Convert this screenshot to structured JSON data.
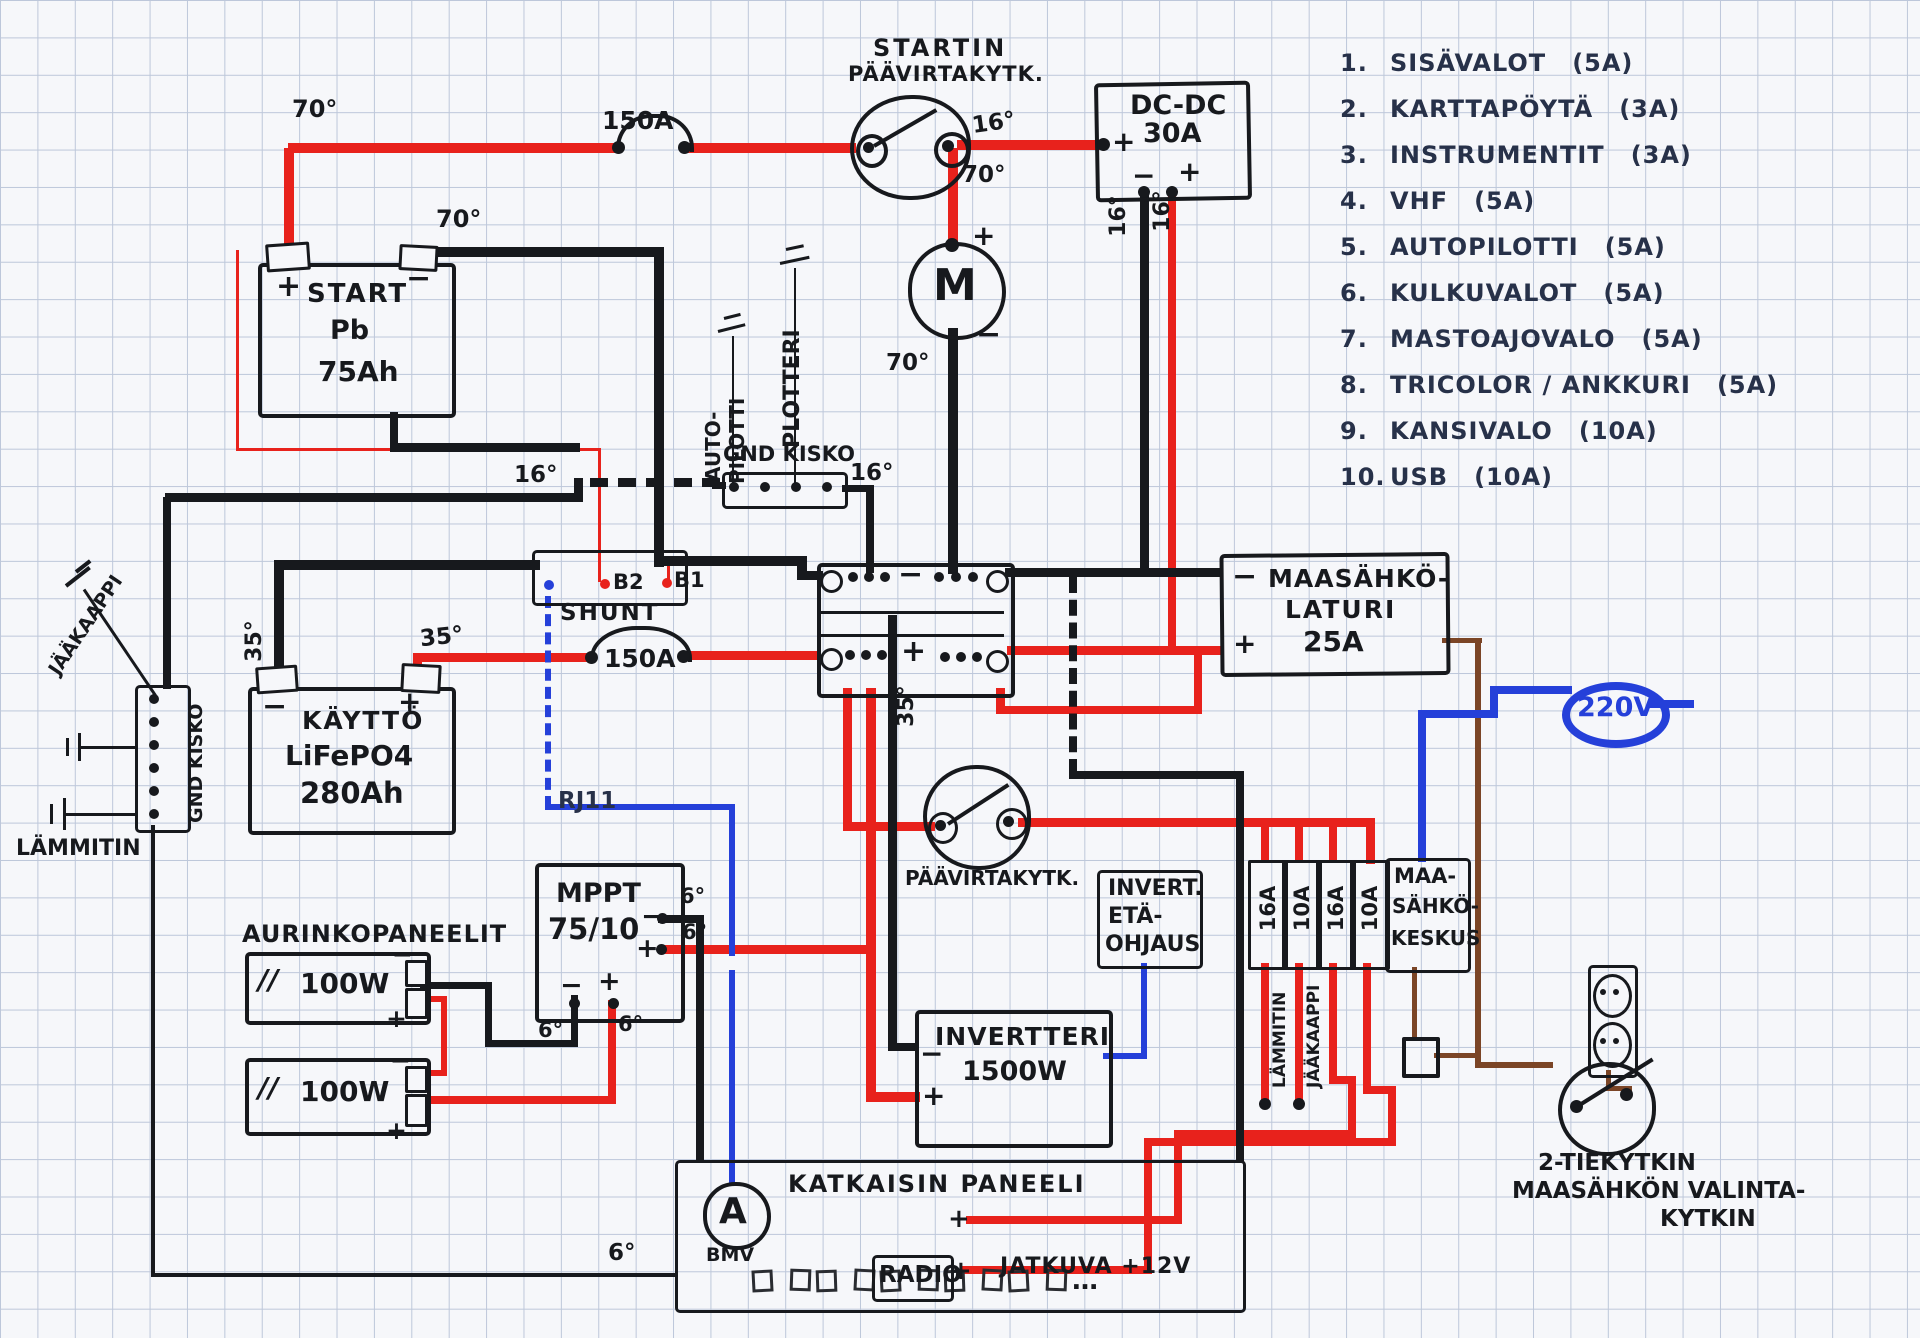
{
  "colors": {
    "paper": "#f6f7fa",
    "grid": "#bdc7da",
    "ink": "#17191d",
    "pen": "#273149",
    "red": "#e8221c",
    "blue": "#2540d9",
    "brown": "#7b4526"
  },
  "symbols": {
    "plus": "+",
    "minus": "−",
    "motor": "M",
    "ammeter": "A",
    "ellipsis": "…",
    "panel_hatch": "//"
  },
  "gauges": {
    "top_red": "70°",
    "start_neg": "70°",
    "switch_out": "16°",
    "switch_down": "70°",
    "motor_neg": "70°",
    "dcdc_neg": "16°",
    "dcdc_pos": "16°",
    "mid_bus": "16°",
    "gnd_bus": "16°",
    "life_neg": "35°",
    "life_pos": "35°",
    "dist_pos": "35°",
    "mppt_out_neg": "6°",
    "mppt_out_pos": "6°",
    "mppt_in_neg": "6°",
    "mppt_in_pos": "6°",
    "gnd_run": "6°"
  },
  "fuses": {
    "main_start": "150A",
    "main_house": "150A"
  },
  "fuse_list": [
    {
      "num": "1.",
      "name": "SISÄVALOT",
      "rating": "(5A)"
    },
    {
      "num": "2.",
      "name": "KARTTAPÖYTÄ",
      "rating": "(3A)"
    },
    {
      "num": "3.",
      "name": "INSTRUMENTIT",
      "rating": "(3A)"
    },
    {
      "num": "4.",
      "name": "VHF",
      "rating": "(5A)"
    },
    {
      "num": "5.",
      "name": "AUTOPILOTTI",
      "rating": "(5A)"
    },
    {
      "num": "6.",
      "name": "KULKUVALOT",
      "rating": "(5A)"
    },
    {
      "num": "7.",
      "name": "MASTOAJOVALO",
      "rating": "(5A)"
    },
    {
      "num": "8.",
      "name": "TRICOLOR / ANKKURI",
      "rating": "(5A)"
    },
    {
      "num": "9.",
      "name": "KANSIVALO",
      "rating": "(10A)"
    },
    {
      "num": "10.",
      "name": "USB",
      "rating": "(10A)"
    }
  ],
  "components": {
    "start_battery": {
      "name": "START",
      "type": "Pb",
      "capacity": "75Ah"
    },
    "starter_switch": {
      "line1": "STARTIN",
      "line2": "PÄÄVIRTAKYTK."
    },
    "dcdc_charger": {
      "name": "DC-DC",
      "rating": "30A"
    },
    "gnd_bus_top": {
      "name": "GND KISKO",
      "dev1_line1": "AUTO-",
      "dev1_line2": "PILOTTI",
      "dev2": "PLOTTERI"
    },
    "shunt": {
      "name": "SHUNT",
      "b1": "B1",
      "b2": "B2"
    },
    "house_battery": {
      "name": "KÄYTTÖ",
      "type": "LiFePO4",
      "capacity": "280Ah"
    },
    "gnd_bus_left": {
      "name": "GND KISKO",
      "heater": "LÄMMITIN",
      "fridge": "JÄÄKAAPPI"
    },
    "shore_charger": {
      "line1": "MAASÄHKÖ-",
      "line2": "LATURI",
      "rating": "25A"
    },
    "rj11": "RJ11",
    "mppt": {
      "name": "MPPT",
      "rating": "75/10"
    },
    "solar": {
      "title": "AURINKOPANEELIT",
      "panel1": "100W",
      "panel2": "100W"
    },
    "main_switch": {
      "label": "PÄÄVIRTAKYTK."
    },
    "inverter_remote": {
      "line1": "INVERT.",
      "line2": "ETÄ-",
      "line3": "OHJAUS"
    },
    "fuse_block": {
      "f1": "16A",
      "f2": "10A",
      "f3": "16A",
      "f4": "10A",
      "load1": "LÄMMITIN",
      "load2": "JÄÄKAAPPI"
    },
    "shore_panel": {
      "line1": "MAA-",
      "line2": "SÄHKÖ-",
      "line3": "KESKUS"
    },
    "inverter": {
      "name": "INVERTTERI",
      "rating": "1500W"
    },
    "breaker_panel": {
      "title": "KATKAISIN PANEELI",
      "meter": "BMV"
    },
    "radio": {
      "name": "RADIO",
      "feed": "JATKUVA +12V"
    },
    "shore_inlet": {
      "voltage": "220V"
    },
    "transfer_switch": {
      "line1": "2-TIEKYTKIN",
      "line2": "MAASÄHKÖN VALINTA-",
      "line3": "KYTKIN"
    }
  }
}
